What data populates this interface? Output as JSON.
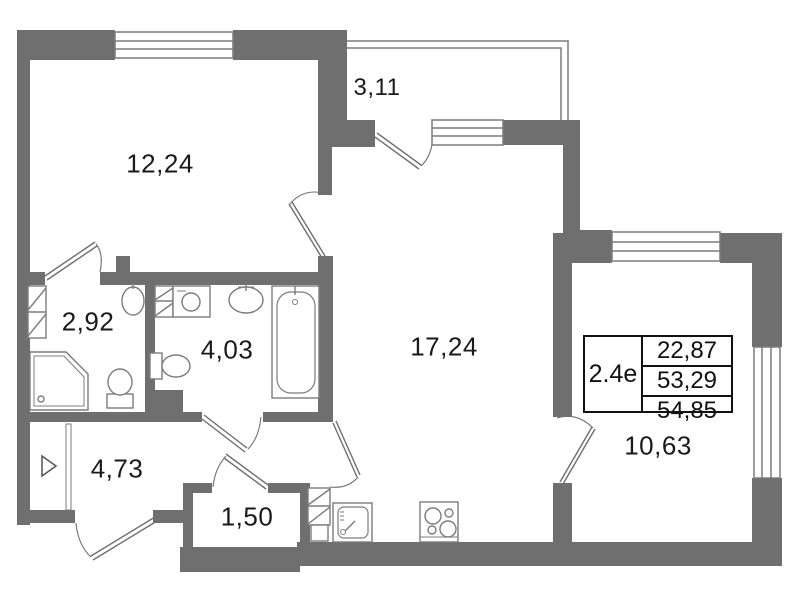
{
  "colors": {
    "wall": "#6f6f6f",
    "fixture_line": "#7c7c7c",
    "door_line": "#6f6f6f",
    "text": "#1a1a1a",
    "table_border": "#111111",
    "background": "#ffffff"
  },
  "rooms": {
    "living": {
      "label": "12,24"
    },
    "balcony": {
      "label": "3,11"
    },
    "wc": {
      "label": "2,92"
    },
    "bathroom": {
      "label": "4,03"
    },
    "kitchen_living": {
      "label": "17,24"
    },
    "bedroom": {
      "label": "10,63"
    },
    "hallway": {
      "label": "4,73"
    },
    "closet": {
      "label": "1,50"
    }
  },
  "info_table": {
    "unit": "2.4е",
    "rows": [
      "22,87",
      "53,29",
      "54,85"
    ]
  }
}
